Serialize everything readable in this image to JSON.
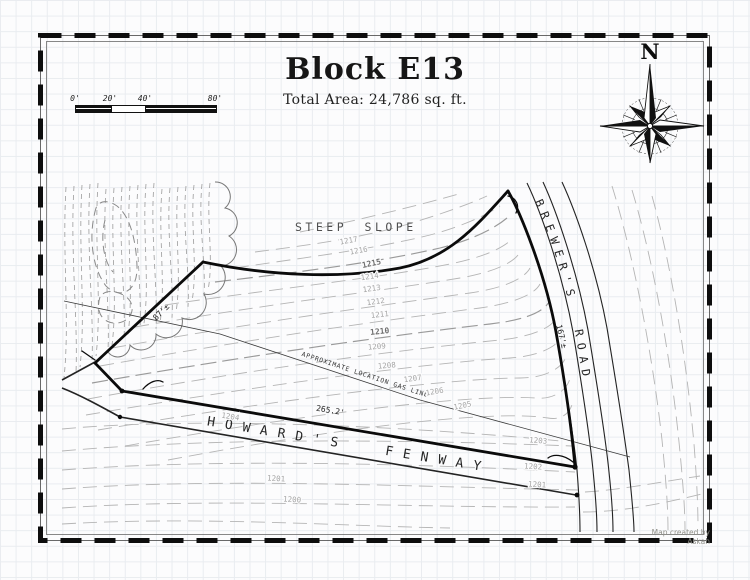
{
  "title": {
    "main": "Block E13",
    "subtitle": "Total Area: 24,786 sq. ft."
  },
  "scale_bar": {
    "labels": [
      "0'",
      "20'",
      "40'",
      "80'"
    ]
  },
  "compass": {
    "north_label": "N"
  },
  "map": {
    "area_labels": {
      "steep_slope": "STEEP SLOPE"
    },
    "roads": {
      "howards_fenway": "HOWARD'S FENWAY",
      "brewers_road": "BREWER'S ROAD"
    },
    "gas_line_label": "APPROXIMATE LOCATION GAS LINE",
    "dimensions": {
      "howards_frontage": "265.2'",
      "west_boundary": "87'±",
      "brewers_frontage": "167'±"
    },
    "contour_labels": [
      "1217",
      "1216",
      "1215",
      "1214",
      "1213",
      "1212",
      "1211",
      "1210",
      "1209",
      "1208",
      "1207",
      "1206",
      "1205",
      "1204",
      "1203",
      "1202",
      "1201",
      "1201",
      "1200"
    ]
  },
  "credit": "Map created by Askan"
}
